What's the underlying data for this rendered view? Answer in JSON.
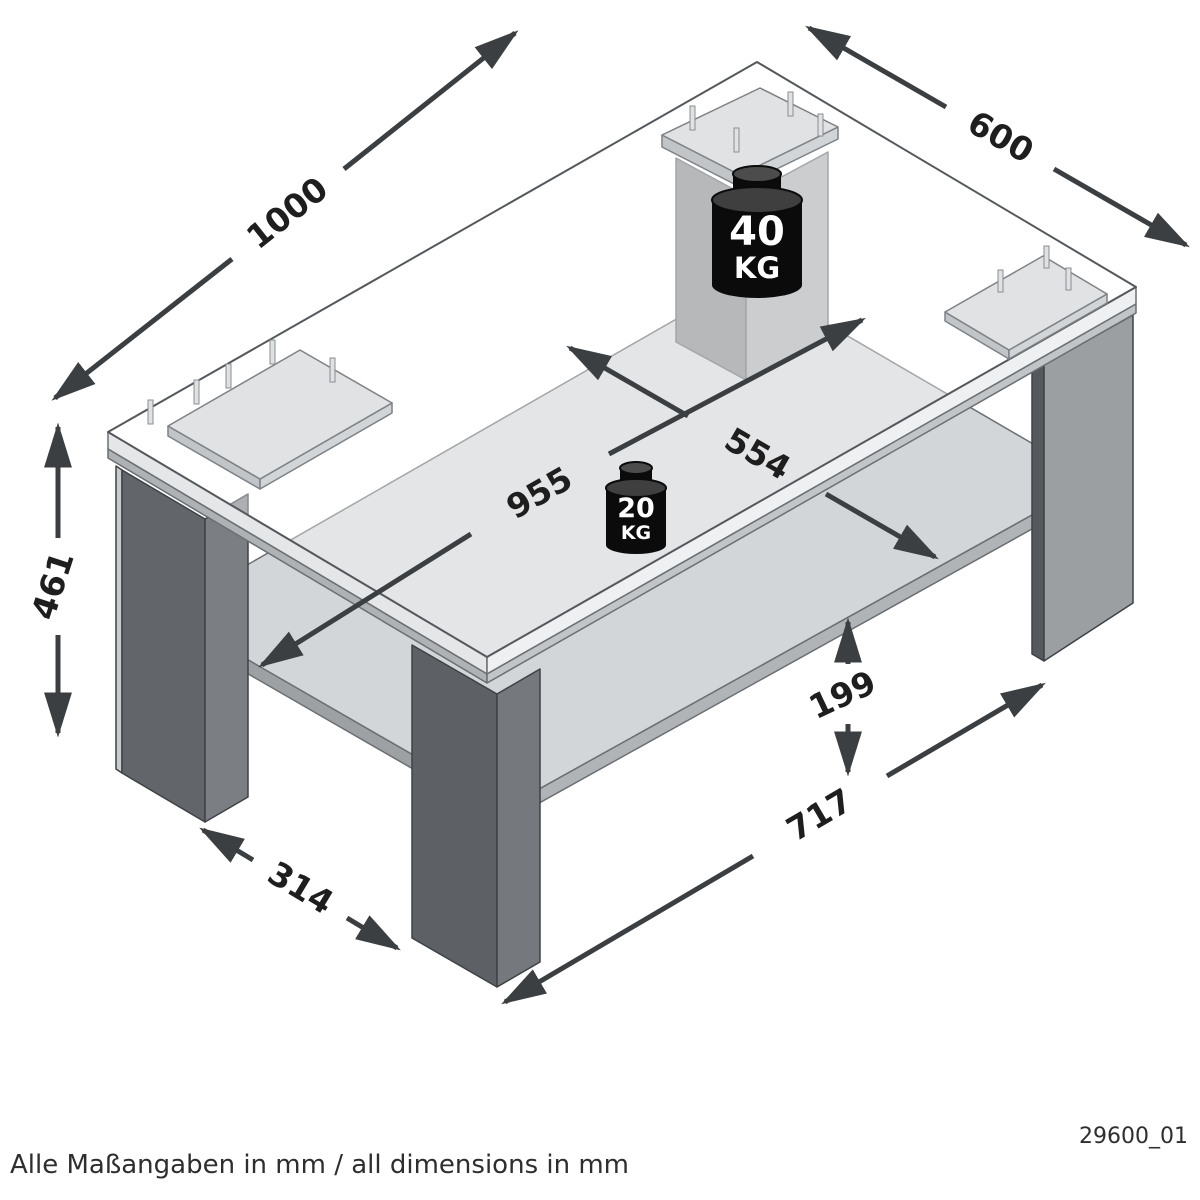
{
  "drawing": {
    "type": "furniture-dimension-diagram",
    "subject": "coffee table with lower shelf",
    "footer_note": "Alle Maßangaben in mm / all dimensions in mm",
    "drawing_number": "29600_01",
    "units": "mm"
  },
  "dimensions": {
    "top_length": "1000",
    "top_depth": "600",
    "height": "461",
    "inner_length": "955",
    "inner_depth": "554",
    "shelf_clearance": "199",
    "leg_span_length": "717",
    "leg_span_depth": "314"
  },
  "loads": {
    "tabletop": {
      "value": "40",
      "unit": "KG"
    },
    "shelf": {
      "value": "20",
      "unit": "KG"
    }
  },
  "colors": {
    "background": "#ffffff",
    "arrow": "#3b3f42",
    "outline": "#54585c",
    "tabletop_edge": "#e4e6e8",
    "shelf": "#d3d6d9",
    "leg_dark": "#62666a",
    "leg_light": "#9b9fa2",
    "weight": "#0b0b0b",
    "label": "#1e1e1e"
  }
}
